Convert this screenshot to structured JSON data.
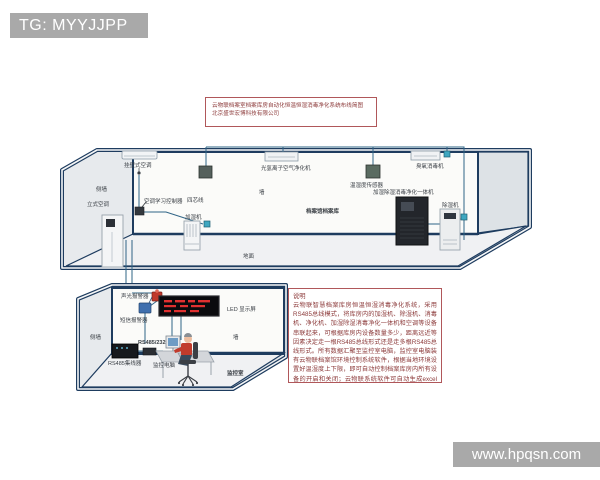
{
  "badge": {
    "text": "TG: MYYJJPP"
  },
  "watermark": {
    "text": "www.hpqsn.com"
  },
  "title_box": {
    "line1": "云物联档案室档案库房自动化恒温恒湿消毒净化系统布线简图",
    "line2": "北京盛世宏博科技有限公司"
  },
  "archive_room": {
    "labels": {
      "wall_ac": "挂壁式空调",
      "side_wall": "侧墙",
      "floor_ac": "立式空调",
      "ac_controller": "空调学习控制器",
      "four_core_wire": "四芯线",
      "humidifier": "加湿机",
      "photo_ion_purifier": "光氢离子空气净化机",
      "wall": "墙",
      "temp_humidity_sensor": "温湿度传感器",
      "room_name": "档案馆档案库",
      "ozone_disinfector": "臭氧消毒机",
      "all_in_one": "加湿除湿消毒净化一体机",
      "dehumidifier": "除湿机",
      "ground": "地面"
    }
  },
  "monitor_room": {
    "labels": {
      "side_wall": "侧墙",
      "sound_light_alarm": "声光报警器",
      "sms_alarm": "短信报警器",
      "led_display": "LED 显示屏",
      "rs485_232": "RS485/232",
      "hub": "RS485集线器",
      "monitor_pc": "监控电脑",
      "wall": "墙",
      "room_name": "监控室"
    }
  },
  "description_box": {
    "heading": "说明",
    "body": "云物联智慧档案库房恒温恒湿消毒净化系统，采用RS485总线模式，将库房内的加湿机、除湿机、消毒机、净化机、加湿除湿消毒净化一体机和空调等设备串联起来，可根据库房内设备数量多少，距离远近等因素决定走一根RS485总线形式还是走多根RS485总线形式。所有数据汇聚至监控室电脑，监控室电脑装有云物联档案馆环境控制系统软件，根据当地环境设置好温湿度上下限，即可自动控制档案库房内所有设备的开启和关闭；云物联系统软件可自动生成excel温湿度数据报表、实时曲线、历史曲线等（北京盛世宏博科技有限公司）"
  },
  "colors": {
    "outline_navy": "#1e3c5f",
    "wire_blue": "#2f6486",
    "connector_teal": "#3fa7c0",
    "box_border_red": "#b0575a",
    "text_red": "#8c3a3a",
    "badge_gray": "#a9a9a9",
    "led_red": "#e03030"
  }
}
